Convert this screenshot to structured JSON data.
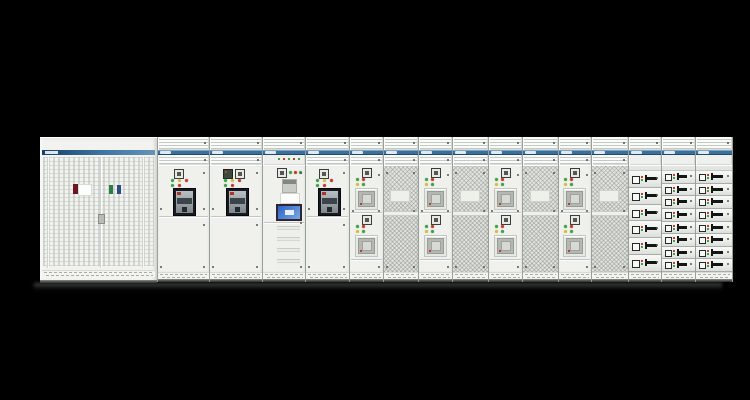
{
  "scene": {
    "description": "Product photo of a low-voltage switchgear and motor control center lineup on a black background",
    "background_color": "#000000",
    "palette": {
      "cabinet_body": "#f1f2ee",
      "panel_line": "#c3c7c1",
      "band_blue": "#3d6f9c",
      "band_blue_dark": "#1d4a74",
      "mesh_gray": "#e2e5df",
      "breaker_window": "#171b21",
      "hmi_screen_blue": "#2e62c8",
      "led_green": "#3fa04a",
      "led_yellow": "#d2bd45",
      "led_red": "#c23b32",
      "handle_black": "#141614"
    },
    "left_cabinet": {
      "kind": "double-door perforated cabinet",
      "brand_label": "",
      "door_count": 2,
      "stickers": [
        {
          "color": "#6e1520",
          "name": "dark-red-sticker"
        },
        {
          "color": "#fdfdfb",
          "name": "white-label"
        },
        {
          "color": "#2e7d46",
          "name": "green-sticker"
        },
        {
          "color": "#2b4b8f",
          "name": "blue-sticker"
        }
      ]
    },
    "sections": [
      {
        "id": "acb-incomer-1",
        "type": "acb",
        "width": 51,
        "label": "",
        "has_display": false
      },
      {
        "id": "acb-incomer-2",
        "type": "acb",
        "width": 52,
        "label": "",
        "has_display": true
      },
      {
        "id": "control-hmi",
        "type": "control",
        "width": 42,
        "label": ""
      },
      {
        "id": "acb-incomer-3",
        "type": "acb",
        "width": 43,
        "label": "",
        "has_display": false
      },
      {
        "id": "feeder-1",
        "type": "meter2",
        "width": 33,
        "label": ""
      },
      {
        "id": "mesh-door-1",
        "type": "mesh",
        "width": 34,
        "label": ""
      },
      {
        "id": "feeder-2",
        "type": "meter2",
        "width": 33,
        "label": ""
      },
      {
        "id": "mesh-door-2",
        "type": "mesh",
        "width": 35,
        "label": ""
      },
      {
        "id": "feeder-3",
        "type": "meter2",
        "width": 33,
        "label": ""
      },
      {
        "id": "mesh-door-3",
        "type": "mesh",
        "width": 35,
        "label": ""
      },
      {
        "id": "feeder-4",
        "type": "meter2",
        "width": 32,
        "label": ""
      },
      {
        "id": "mesh-door-4",
        "type": "mesh",
        "width": 36,
        "label": ""
      },
      {
        "id": "mcc-drawers-1",
        "type": "mcc",
        "width": 32,
        "label": "",
        "rows": 6,
        "size": "large"
      },
      {
        "id": "mcc-drawers-2",
        "type": "mcc",
        "width": 33,
        "label": "",
        "rows": 8,
        "size": "small"
      },
      {
        "id": "mcc-drawers-3",
        "type": "mcc",
        "width": 36,
        "label": "",
        "rows": 8,
        "size": "small"
      }
    ]
  }
}
